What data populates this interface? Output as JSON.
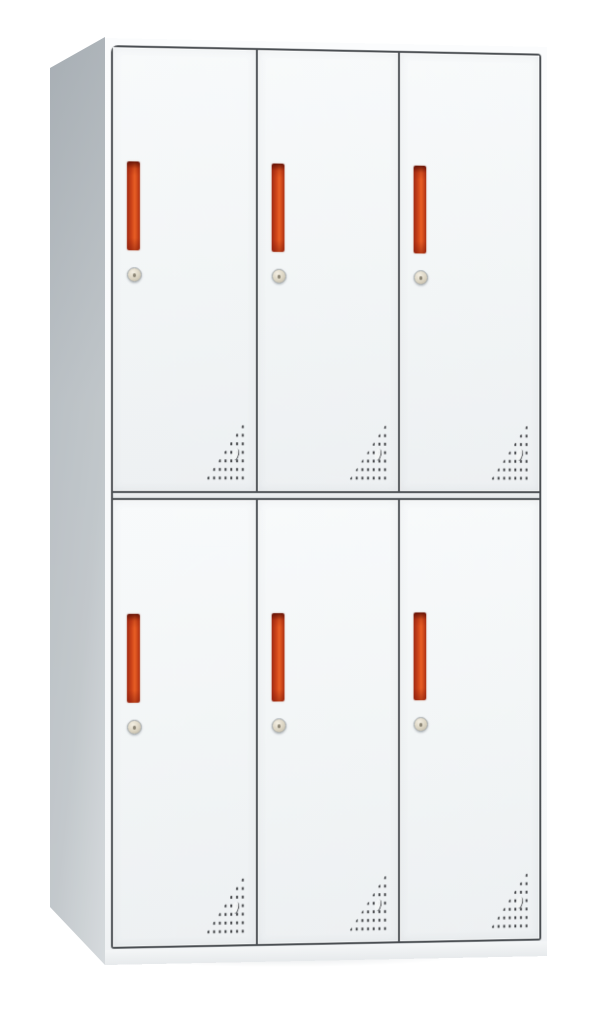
{
  "meta": {
    "description": "Product photograph of a white six-door steel locker cabinet on a plain white background",
    "view": "three-quarter view, left side panel visible, front face receding slightly to the right",
    "visible_text": ""
  },
  "cabinet": {
    "door_rows": 2,
    "door_columns": 3,
    "total_doors": 6,
    "door_features": [
      "vertical recessed red handle in upper-left area of each door",
      "round keyed cam lock centered below each handle",
      "triangular field of perforated ventilation dots at the bottom-right corner of each door",
      "small crescent-shaped stamped mark inside each perforation field"
    ],
    "frame": "dark thin seam lines outline each door; horizontal double seam separates upper and lower rows",
    "base": "narrow white plinth strip below the doors with a soft floor shadow"
  },
  "colors": {
    "background": "#ffffff",
    "door_face": "#f2f5f6",
    "frame_line": "#4a4e52",
    "side_panel": "#bdc3c7",
    "handle_red_dark": "#a02912",
    "handle_red_bright": "#e95f25",
    "lock_face": "#dad3c1",
    "vent_dot": "#3f4144"
  }
}
